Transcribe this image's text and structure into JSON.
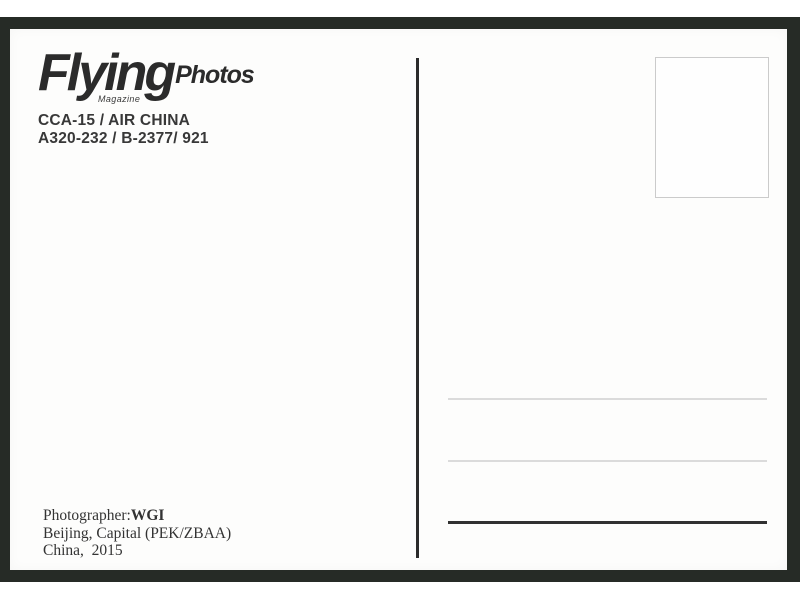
{
  "colors": {
    "frame": "#262b26",
    "ink": "#2b2b2b",
    "light_line": "#dbdbdb",
    "dark_line": "#313131",
    "stamp_border": "#cbcbcb"
  },
  "logo": {
    "brand": "Flying",
    "suffix": "Photos",
    "tagline": "Magazine"
  },
  "caption": {
    "line1": "CCA-15 / AIR CHINA",
    "line2": "A320-232 / B-2377/ 921"
  },
  "credits": {
    "photographer_label": "Photographer:",
    "photographer_name": "WGI",
    "location": "Beijing, Capital (PEK/ZBAA)",
    "country_year": "China,  2015"
  }
}
